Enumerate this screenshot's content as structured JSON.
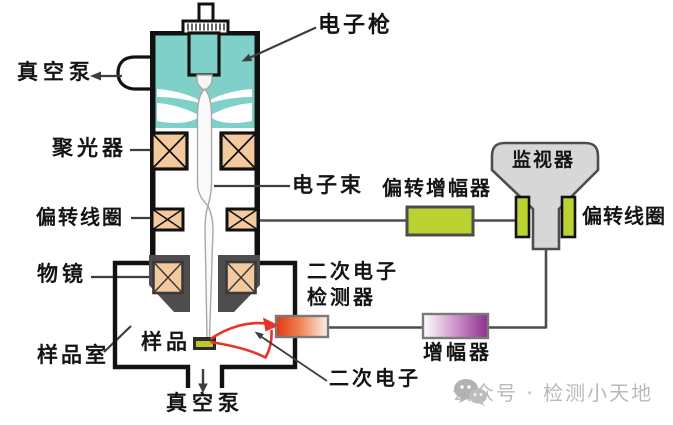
{
  "labels": {
    "electron_gun": "电子枪",
    "vacuum_pump_top": "真空泵",
    "condenser": "聚光器",
    "electron_beam": "电子束",
    "deflection_coil_left": "偏转线圈",
    "objective_lens": "物镜",
    "sample": "样品",
    "sample_chamber": "样品室",
    "vacuum_pump_bottom": "真空泵",
    "deflection_amplifier": "偏转增幅器",
    "monitor": "监视器",
    "deflection_coil_right": "偏转线圈",
    "se_detector_line1": "二次电子",
    "se_detector_line2": "检测器",
    "amplifier": "增幅器",
    "secondary_electron": "二次电子"
  },
  "watermark": {
    "icon": "wechat-icon",
    "text": "公众号 · 检测小天地"
  },
  "colors": {
    "gun_body": "#7ED0C9",
    "lens_fill": "#F5C99E",
    "accent_green": "#BCD232",
    "monitor_gray": "#D7D7D7",
    "objective_gray": "#4D4D4D",
    "detector_red": "#DD3A10",
    "amplifier_purple": "#8E2F90",
    "fan_red": "#E6352B",
    "sample_green": "#BFC62A",
    "outline": "#111111",
    "line_gray": "#4D4D4D",
    "watermark_gray": "#B9B9B9"
  }
}
